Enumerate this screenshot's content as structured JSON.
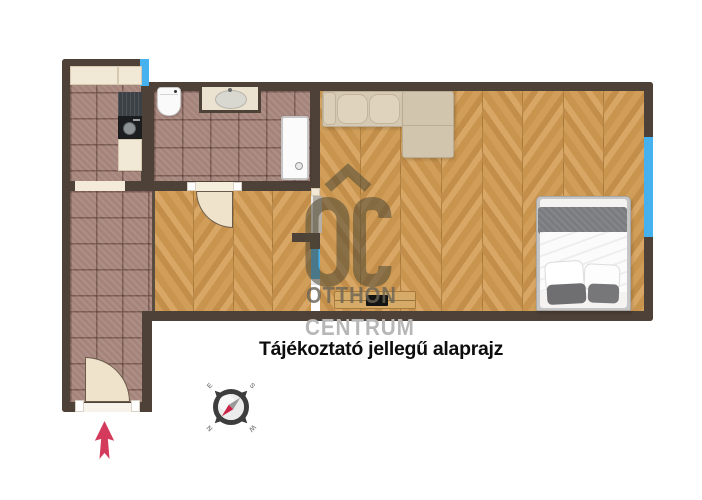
{
  "disclaimer": {
    "text": "Tájékoztató jellegű alaprajz"
  },
  "watermark": {
    "logo": "OC-otthon-centrum-logo",
    "line1": "OTTHON",
    "line2": "CENTRUM"
  },
  "compass": {
    "e": "E",
    "s": "S",
    "n": "N",
    "w": "W"
  },
  "icons": {
    "entrance_arrow": "entrance-direction-arrow",
    "compass_rose": "compass-rose"
  },
  "colors": {
    "wall": "#4e4138",
    "tile_floor": "#a9887f",
    "wood_floor": "#cd9b55",
    "window": "#45b2ef",
    "entrance_arrow": "#d43a5c",
    "door": "#efe3cc",
    "watermark_logo": "#57503d",
    "watermark_centrum": "#b7b7b7",
    "disclaimer_text": "#0d0d0d"
  }
}
